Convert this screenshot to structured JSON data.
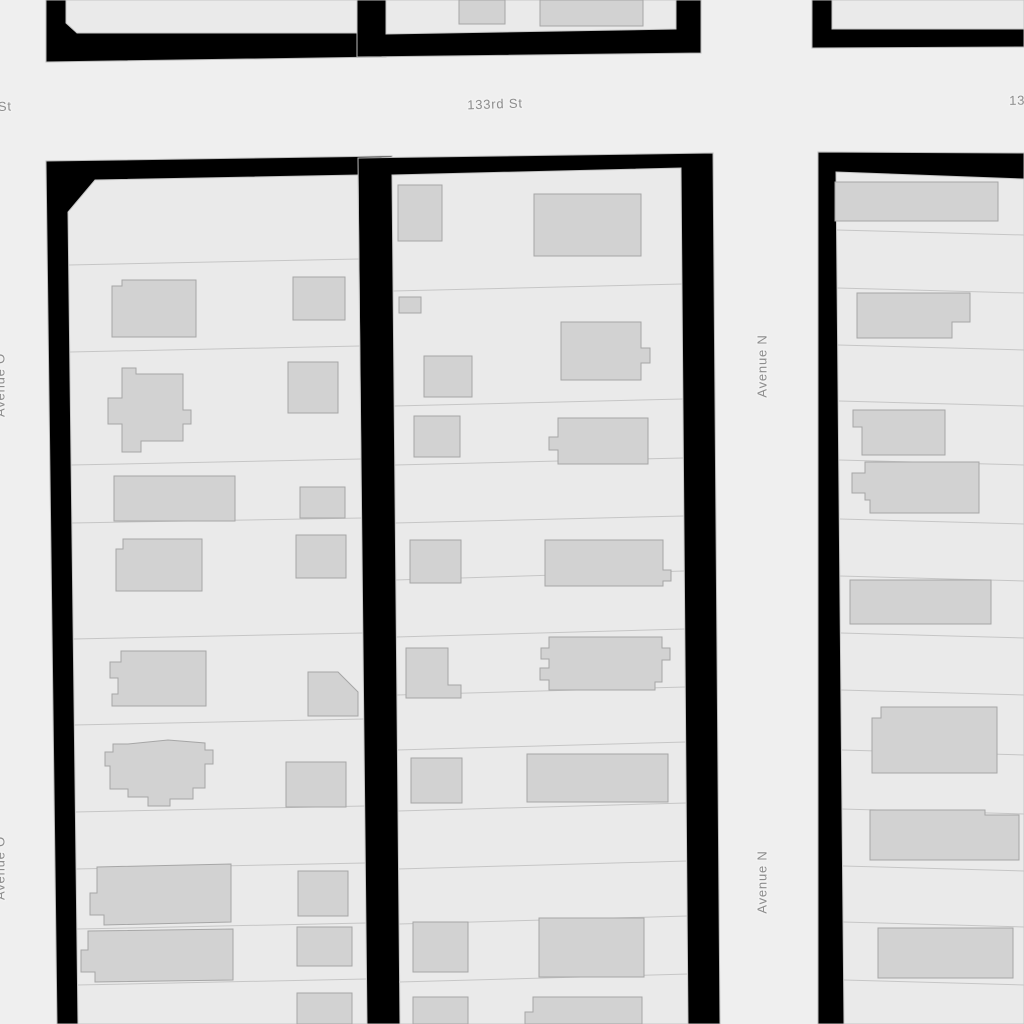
{
  "map": {
    "title": "parcel map",
    "streets": {
      "horizontal": "133rd St",
      "vertical_right": "Avenue N",
      "vertical_left": "Avenue O"
    },
    "labels": [
      {
        "text": "133rd St",
        "x": 495,
        "y": 105,
        "rotate": -2
      },
      {
        "text": "133rd St",
        "x": -16,
        "y": 108,
        "rotate": -2
      },
      {
        "text": "133rd St",
        "x": 1037,
        "y": 101,
        "rotate": -1
      },
      {
        "text": "Avenue N",
        "x": 763,
        "y": 366,
        "rotate": -90
      },
      {
        "text": "Avenue N",
        "x": 763,
        "y": 882,
        "rotate": -90
      },
      {
        "text": "Avenue O",
        "x": 1,
        "y": 385,
        "rotate": -90
      },
      {
        "text": "Avenue O",
        "x": 1,
        "y": 868,
        "rotate": -90
      }
    ],
    "colors": {
      "street": "#efefef",
      "block_outline": "#000000",
      "outline_edge": "#bbbbbb",
      "parcel_fill": "#eaeaea",
      "parcel_stroke": "#c6c6c6",
      "building_fill": "#d2d2d2",
      "building_stroke": "#a6a6a6",
      "label_color": "#8d8d8d",
      "label_halo": "#f2f2f2"
    },
    "blocks": [
      {
        "name": "block-top-left",
        "outline": "46,0 386,0 386,57 46,62",
        "interior": "66,0 357,0 357,33 77,33 66,23",
        "dividers": [],
        "buildings": []
      },
      {
        "name": "block-top-middle",
        "outline": "357,0 701,0 701,53 357,57",
        "interior": "386,0 676,0 676,29 386,34",
        "dividers": [],
        "buildings": [
          "459,0 505,0 505,24 459,24",
          "540,0 643,0 643,26 540,26"
        ]
      },
      {
        "name": "block-top-right",
        "outline": "812,0 1024,0 1024,47 812,48",
        "interior": "832,0 1024,0 1024,29 832,29",
        "dividers": [],
        "buildings": []
      },
      {
        "name": "block-left",
        "outline": "46,161 392,156 400,1024 57,1024",
        "interior": "95,180 358,175 367,1024 78,1024 68,212",
        "dividers": [
          [
            69,
            265,
            359,
            259
          ],
          [
            70,
            352,
            360,
            346
          ],
          [
            71,
            465,
            361,
            459
          ],
          [
            72,
            523,
            362,
            518
          ],
          [
            73,
            639,
            363,
            633
          ],
          [
            74,
            725,
            364,
            719
          ],
          [
            75,
            812,
            365,
            806
          ],
          [
            76,
            869,
            365,
            863
          ],
          [
            77,
            929,
            366,
            923
          ],
          [
            77,
            985,
            366,
            979
          ]
        ],
        "buildings": [
          "122,280 196,280 196,337 112,337 112,286 122,286",
          "293,277 345,277 345,320 293,320",
          "122,368 136,368 136,374 183,374 183,410 191,410 191,424 183,424 183,441 141,441 141,452 122,452 122,424 108,424 108,398 122,398",
          "288,362 338,362 338,413 288,413",
          "114,476 235,476 235,521 114,521",
          "300,487 345,487 345,518 300,518",
          "123,539 202,539 202,591 116,591 116,549 123,549",
          "296,535 346,535 346,578 296,578",
          "121,651 206,651 206,706 112,706 112,694 118,694 118,678 110,678 110,662 121,662",
          "308,672 338,672 358,692 358,716 308,716",
          "128,744 168,740 205,743 205,750 213,750 213,764 205,764 205,788 193,788 193,799 170,799 170,806 148,806 148,797 128,797 128,789 110,789 110,766 105,766 105,752 113,752 113,744",
          "286,762 346,762 346,807 286,807",
          "97,867 231,864 231,922 104,925 104,915 90,915 90,893 97,893",
          "298,871 348,871 348,916 298,916",
          "88,931 233,929 233,980 95,982 95,972 81,972 81,950 88,950",
          "297,927 352,927 352,966 297,966",
          "297,993 352,993 352,1024 297,1024"
        ]
      },
      {
        "name": "block-middle",
        "outline": "358,158 713,153 720,1024 366,1024",
        "interior": "392,175 681,168 688,1024 400,1024",
        "dividers": [
          [
            393,
            291,
            682,
            284
          ],
          [
            394,
            406,
            683,
            399
          ],
          [
            395,
            465,
            683,
            458
          ],
          [
            395,
            523,
            684,
            516
          ],
          [
            396,
            580,
            684,
            571
          ],
          [
            396,
            637,
            685,
            629
          ],
          [
            397,
            695,
            685,
            687
          ],
          [
            397,
            750,
            686,
            742
          ],
          [
            398,
            811,
            686,
            803
          ],
          [
            398,
            869,
            687,
            861
          ],
          [
            399,
            924,
            687,
            916
          ],
          [
            399,
            982,
            688,
            974
          ]
        ],
        "buildings": [
          "398,185 442,185 442,241 398,241",
          "534,194 641,194 641,256 534,256",
          "399,297 421,297 421,313 399,313",
          "424,356 472,356 472,397 424,397",
          "561,322 641,322 641,348 650,348 650,363 641,363 641,380 561,380",
          "414,416 460,416 460,457 414,457",
          "558,418 648,418 648,464 558,464 558,450 549,450 549,437 558,437",
          "410,540 461,540 461,583 410,583",
          "545,540 663,540 663,570 671,570 671,581 663,581 663,586 545,586",
          "406,648 448,648 448,685 461,685 461,698 406,698",
          "549,637 662,637 662,648 670,648 670,660 662,660 662,682 655,682 655,690 549,690 549,680 540,680 540,668 549,668 549,659 541,659 541,648 549,648",
          "411,758 462,758 462,803 411,803",
          "527,754 668,754 668,802 527,802",
          "413,922 468,922 468,972 413,972",
          "539,918 644,918 644,977 539,977",
          "413,997 468,997 468,1024 413,1024",
          "533,997 642,997 642,1024 525,1024 525,1012 533,1012"
        ]
      },
      {
        "name": "block-right",
        "outline": "818,152 1024,153 1024,1024 818,1024",
        "interior": "836,172 1024,179 1024,1024 844,1024",
        "dividers": [
          [
            837,
            230,
            1024,
            235
          ],
          [
            837,
            288,
            1024,
            293
          ],
          [
            838,
            345,
            1024,
            350
          ],
          [
            839,
            401,
            1024,
            406
          ],
          [
            839,
            460,
            1024,
            465
          ],
          [
            840,
            519,
            1024,
            524
          ],
          [
            840,
            576,
            1024,
            581
          ],
          [
            841,
            633,
            1024,
            638
          ],
          [
            841,
            690,
            1024,
            695
          ],
          [
            842,
            750,
            1024,
            755
          ],
          [
            842,
            809,
            1024,
            814
          ],
          [
            843,
            866,
            1024,
            871
          ],
          [
            843,
            922,
            1024,
            927
          ],
          [
            844,
            980,
            1024,
            985
          ]
        ],
        "buildings": [
          "835,182 998,182 998,221 835,221",
          "857,293 970,293 970,322 952,322 952,338 857,338",
          "853,410 945,410 945,455 862,455 862,427 853,427",
          "865,462 979,462 979,513 870,513 870,500 865,500 865,493 852,493 852,473 865,473",
          "850,580 991,580 991,624 850,624",
          "881,707 997,707 997,773 872,773 872,718 881,718",
          "870,810 985,810 985,815 1019,815 1019,860 870,860",
          "878,928 1013,928 1013,978 878,978"
        ]
      }
    ]
  }
}
